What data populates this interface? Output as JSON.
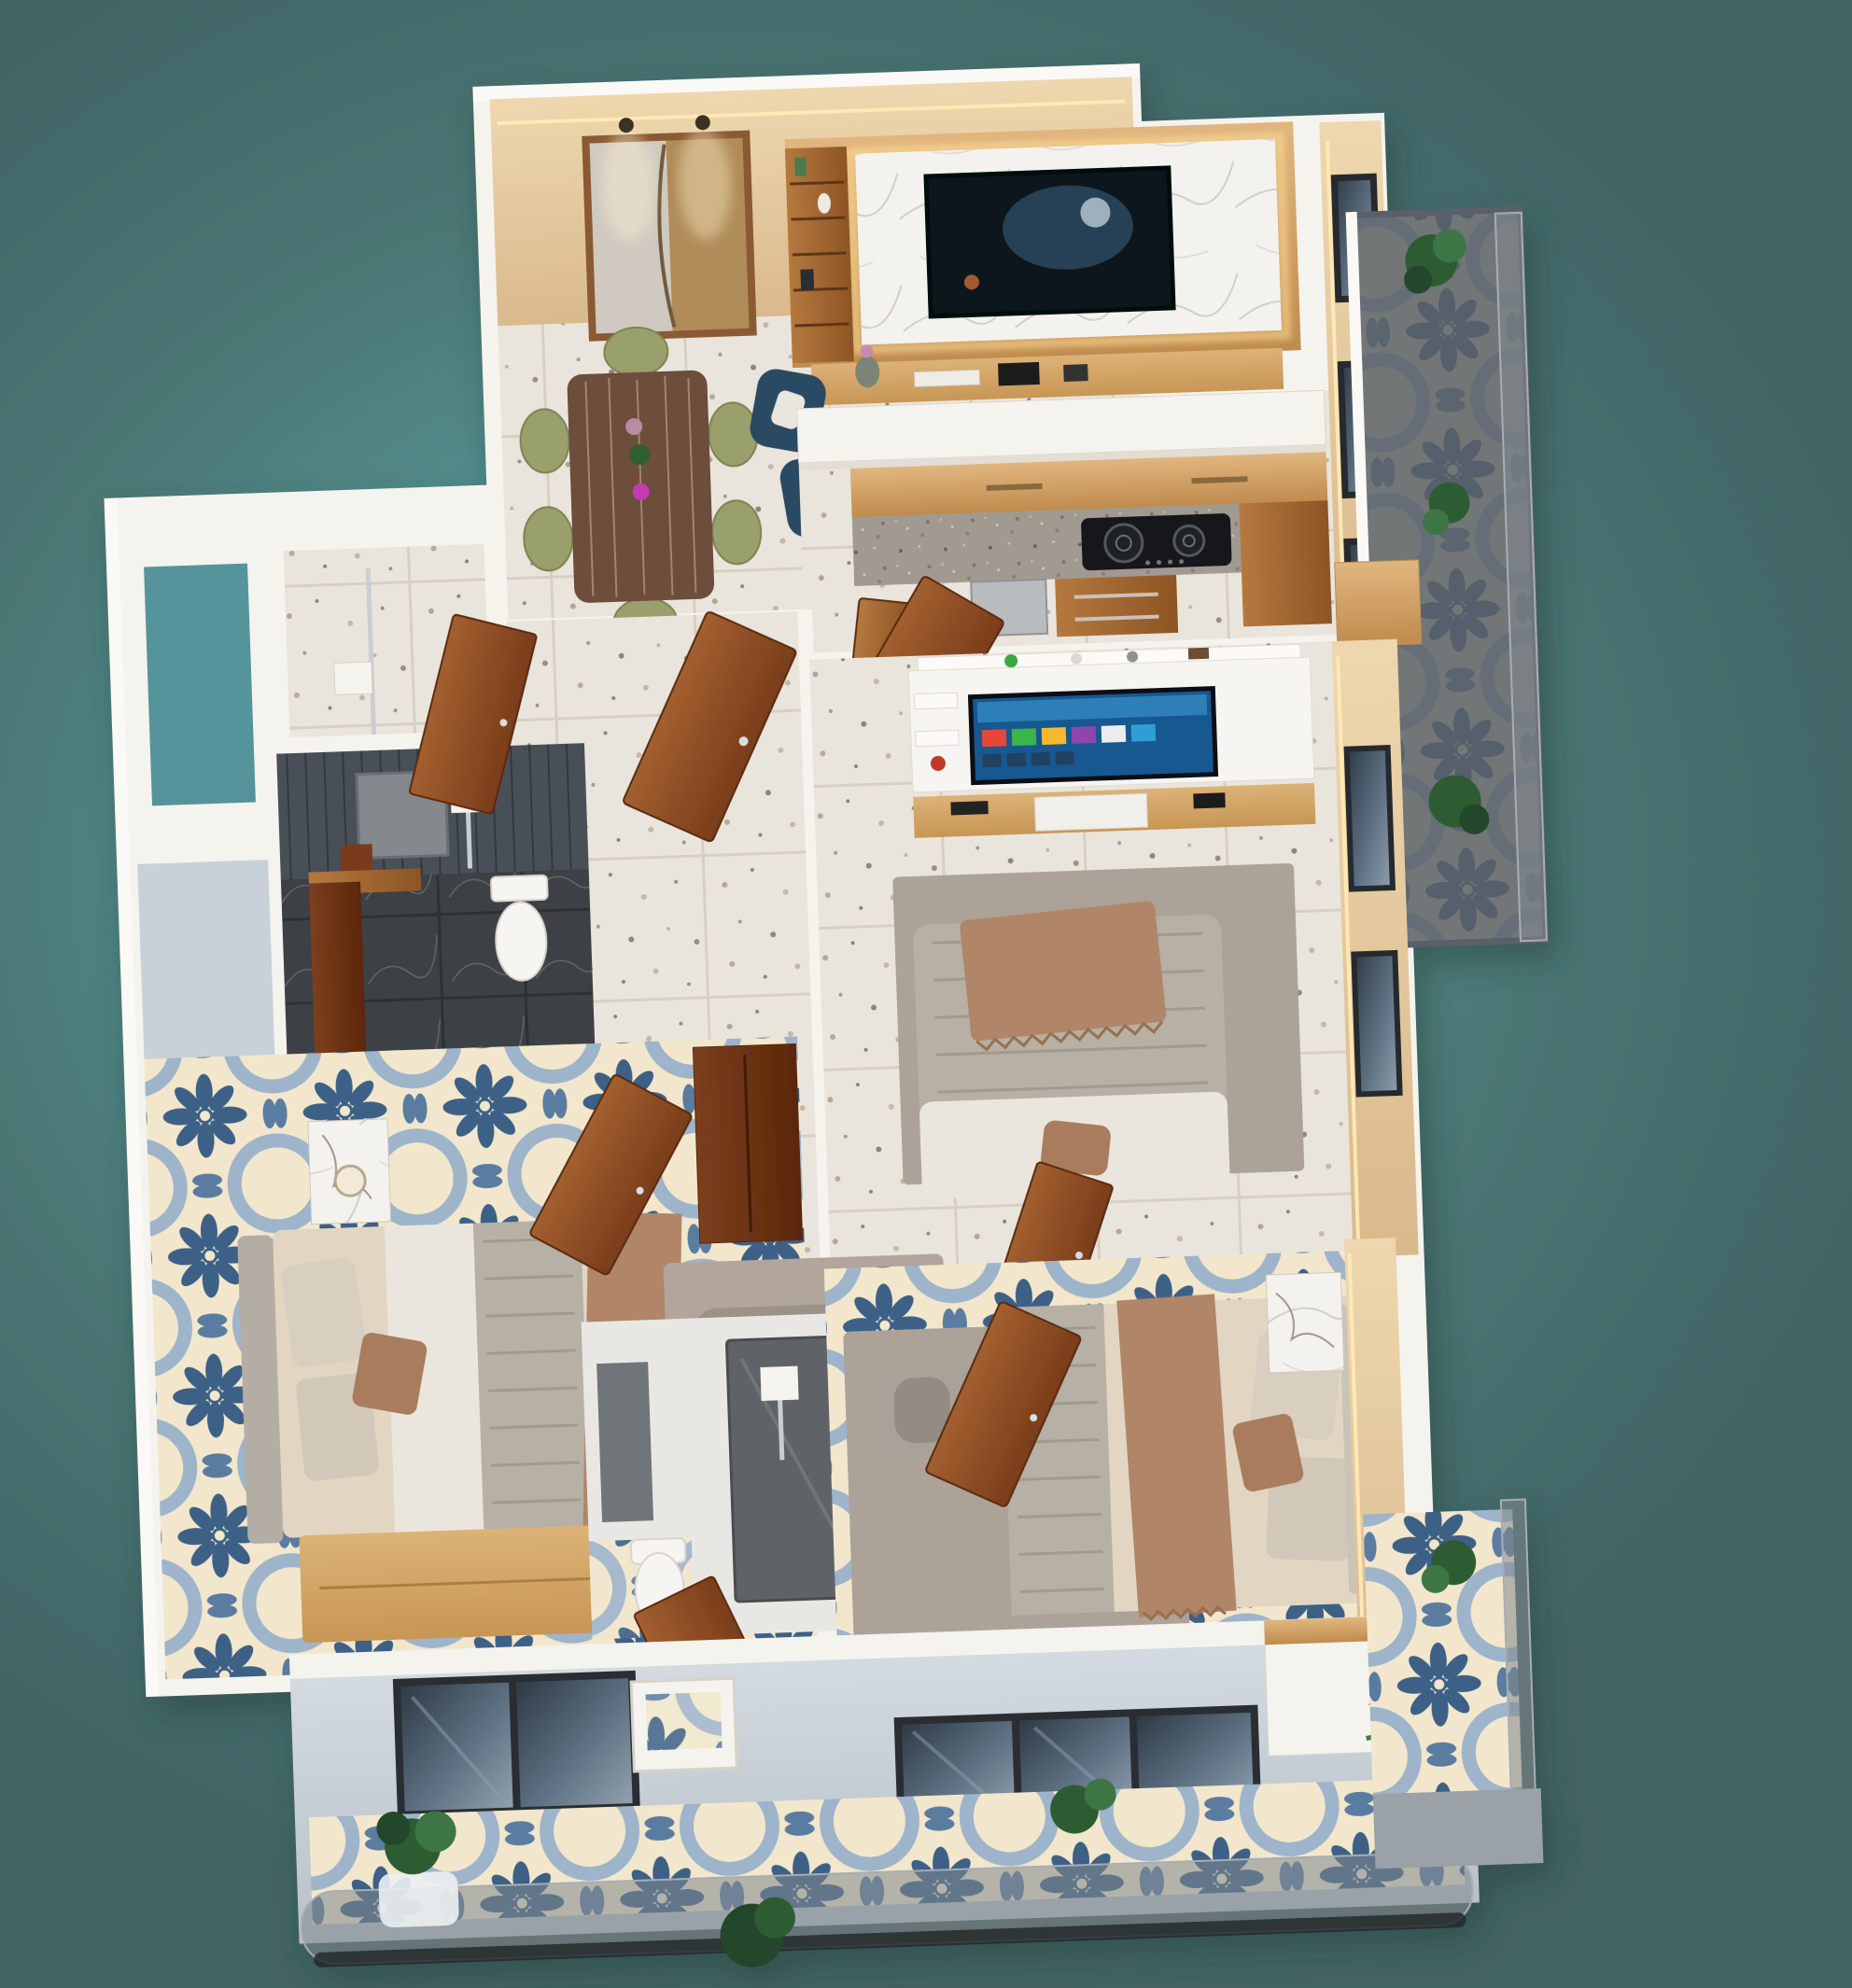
{
  "scene": {
    "type": "3d-apartment-floor-plan-render",
    "view": "isometric-top-down",
    "visible_text": [],
    "background": "teal-gradient"
  },
  "palette": {
    "teal-center": "#5fa7a4",
    "teal-edge": "#44696a",
    "wall-white": "#f5f3ee",
    "beige-wall": "#e6cda6",
    "exterior-wall": "#ccd3da",
    "terrazzo-floor": "#eae5dc",
    "tile-cream": "#f2e7cc",
    "tile-blue": "#3c6186",
    "tile-blue-light": "#9eb4ca",
    "wood-door": "#8a4a26",
    "wood-oak": "#d3a367",
    "granite": "#a19a90",
    "navy-chair": "#2b4a63",
    "olive-chair": "#99a06c",
    "dark-panel": "#4a5056",
    "dark-marble": "#3d4145",
    "glass-window": "#3c4a58",
    "rug-gray": "#ada298",
    "bed-cream": "#e2d6c3",
    "throw-brown": "#b08568",
    "plant-green": "#2e5b33",
    "led-warm": "#ffe9b4"
  },
  "rooms": [
    {
      "name": "living-dining-room",
      "floor": "terrazzo",
      "features": [
        "beige-accent-wall",
        "led-cove-lighting",
        "two-panel-wall-art",
        "picture-lights",
        "marble-tv-panel",
        "wall-tv",
        "wood-shelf-unit",
        "wood-console",
        "dining-table-decor",
        "six-olive-chairs",
        "two-navy-armchairs"
      ]
    },
    {
      "name": "kitchen",
      "floor": "terrazzo",
      "features": [
        "white-island-counter",
        "wood-upper-cabinets",
        "granite-countertop",
        "two-burner-gas-hob",
        "steel-module",
        "wood-drawers"
      ]
    },
    {
      "name": "master-bedroom",
      "floor": "terrazzo",
      "features": [
        "smart-tv-unit",
        "floating-shelf-decor",
        "wood-console",
        "double-bed",
        "brown-throw",
        "gray-rug",
        "beige-accent-wall",
        "wood-doors",
        "windows"
      ]
    },
    {
      "name": "bedroom-2",
      "floor": "blue-patterned-tile",
      "features": [
        "double-bed",
        "gray-headboard",
        "marble-nightstand-lamp",
        "gray-rug-bolster",
        "light-wood-dresser",
        "wood-wardrobe",
        "sliding-window",
        "wood-door"
      ]
    },
    {
      "name": "bedroom-3",
      "floor": "blue-patterned-tile",
      "features": [
        "double-bed",
        "gray-daybed",
        "gray-rug",
        "marble-nightstand-lamp",
        "tan-accent-wall",
        "light-wood-dresser",
        "sliding-glass-doors",
        "wood-door"
      ]
    },
    {
      "name": "bathroom-1",
      "features": [
        "dark-paneled-wall",
        "mirror",
        "toilet",
        "shower-set",
        "dark-marble-floor",
        "wood-vanity-partition",
        "wood-door"
      ]
    },
    {
      "name": "bathroom-2",
      "features": [
        "smoked-glass-shower",
        "toilet",
        "gray-vanity",
        "wood-door"
      ]
    },
    {
      "name": "utility-court",
      "features": [
        "terrazzo-floor",
        "chrome-pipe",
        "open-shaft-to-sky"
      ]
    },
    {
      "name": "hallway",
      "floor": "terrazzo"
    },
    {
      "name": "front-balcony",
      "floor": "blue-patterned-tile",
      "features": [
        "smoked-glass-railing",
        "plants",
        "sliding-window",
        "white-box-window",
        "white-column"
      ]
    },
    {
      "name": "right-side-balcony",
      "floor": "dark-tile",
      "features": [
        "glass-railing",
        "plants",
        "palm-plant"
      ]
    }
  ]
}
